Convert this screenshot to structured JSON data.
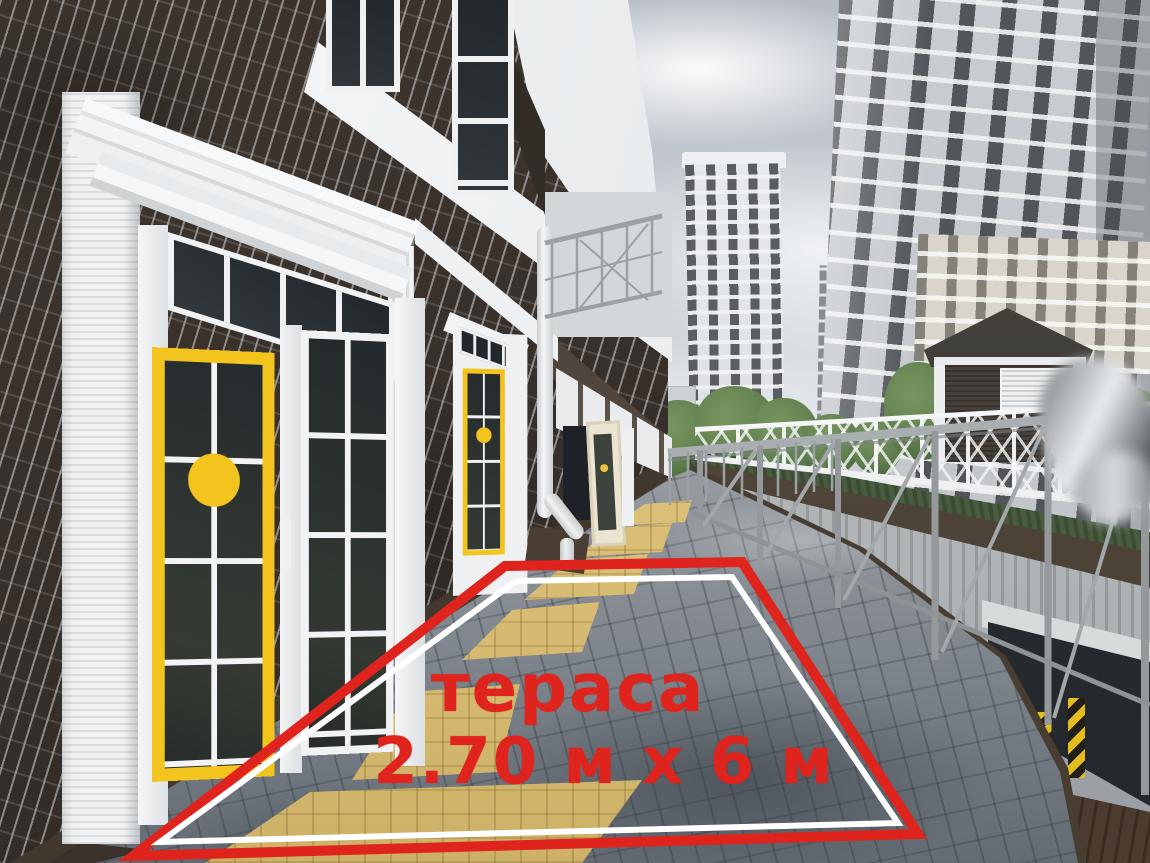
{
  "scene": {
    "type": "photograph",
    "subject": "street-level photo of a residential building facade with yellow-framed doors, a paved walkway outlined in red marking a terrace, a metal fence over an underground parking ramp, and high-rise apartment towers in the background"
  },
  "annotation": {
    "title": "тераса",
    "dimensions": "2.70 м х 6 м",
    "text_color": "#df231d",
    "outline_color": "#df231d",
    "inner_line_color": "#ffffff"
  },
  "colors": {
    "red": "#df231d",
    "brick": "#352d27",
    "mortar": "#d0d4d8",
    "trim": "#eff1f2",
    "yellow": "#f2c41d",
    "glass": "#23282c",
    "sky-top": "#b6bcc6",
    "sky-light": "#e4e7ea",
    "pavement": "#8b9197",
    "tactile": "#dcbf77",
    "fence-gray": "#9ba0a3",
    "concrete": "#c7cacc",
    "curb-brown": "#473d31",
    "hedge": "#4a5c40",
    "tree": "#5f7e4f",
    "kiosk-dark": "#46403a",
    "kiosk-roof": "#33302c",
    "pit-dark": "#24272b",
    "door-green": "#2d5c4a",
    "warn-yellow": "#e3bd1e"
  }
}
